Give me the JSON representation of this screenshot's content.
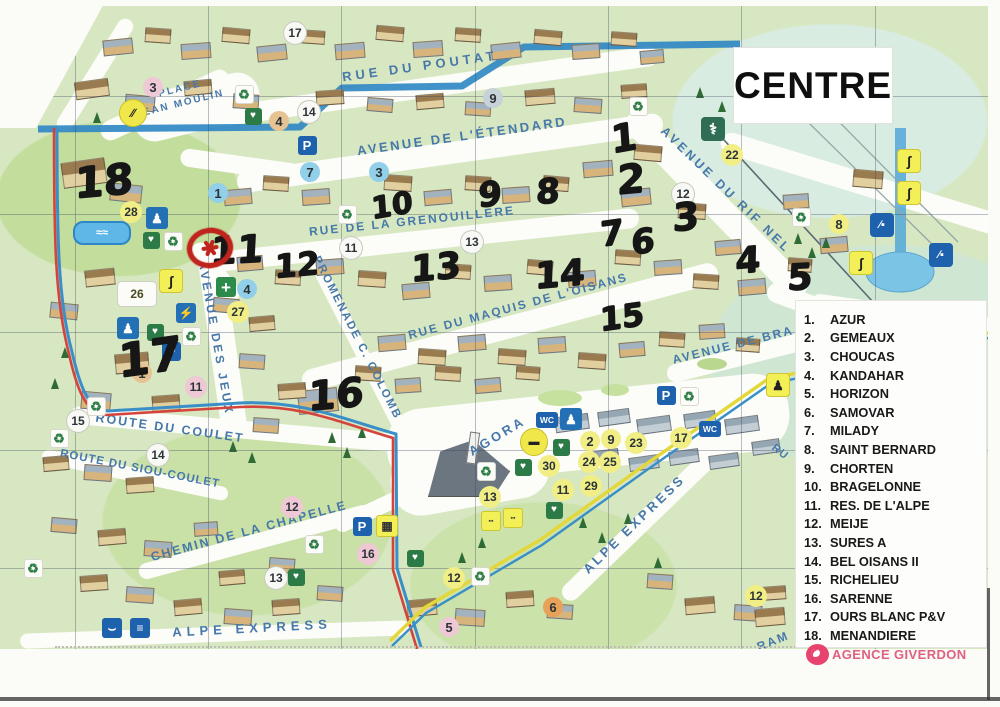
{
  "page": {
    "title": "CENTRE"
  },
  "legend": {
    "items": [
      {
        "num": "1.",
        "name": "AZUR"
      },
      {
        "num": "2.",
        "name": "GEMEAUX"
      },
      {
        "num": "3.",
        "name": "CHOUCAS"
      },
      {
        "num": "4.",
        "name": "KANDAHAR"
      },
      {
        "num": "5.",
        "name": "HORIZON"
      },
      {
        "num": "6.",
        "name": "SAMOVAR"
      },
      {
        "num": "7.",
        "name": "MILADY"
      },
      {
        "num": "8.",
        "name": "SAINT BERNARD"
      },
      {
        "num": "9.",
        "name": "CHORTEN"
      },
      {
        "num": "10.",
        "name": "BRAGELONNE"
      },
      {
        "num": "11.",
        "name": "RES. DE L'ALPE"
      },
      {
        "num": "12.",
        "name": "MEIJE"
      },
      {
        "num": "13.",
        "name": "SURES A"
      },
      {
        "num": "14.",
        "name": "BEL OISANS II"
      },
      {
        "num": "15.",
        "name": "RICHELIEU"
      },
      {
        "num": "16.",
        "name": "SARENNE"
      },
      {
        "num": "17.",
        "name": "OURS BLANC P&V"
      },
      {
        "num": "18.",
        "name": "MENANDIERE"
      }
    ]
  },
  "agency": {
    "name": "AGENCE GIVERDON"
  },
  "map": {
    "street_labels": [
      {
        "text": "ROU.",
        "x": 80,
        "y": 38,
        "rotate": -58,
        "size": 11,
        "spacing": 2
      },
      {
        "text": "RUE DU POUTAT",
        "x": 420,
        "y": 66,
        "rotate": -8,
        "size": 13,
        "spacing": 4
      },
      {
        "text": "PLACE",
        "x": 180,
        "y": 89,
        "rotate": -14,
        "size": 10,
        "spacing": 2
      },
      {
        "text": "JEAN MOULIN",
        "x": 180,
        "y": 104,
        "rotate": -14,
        "size": 10,
        "spacing": 2
      },
      {
        "text": "AVENUE DE L'ÉTENDARD",
        "x": 462,
        "y": 136,
        "rotate": -8,
        "size": 13,
        "spacing": 2.5
      },
      {
        "text": "RUE DE LA GRENOUILLERE",
        "x": 412,
        "y": 221,
        "rotate": -6,
        "size": 12,
        "spacing": 2
      },
      {
        "text": "RUE DU MAQUIS DE L'OISANS",
        "x": 518,
        "y": 306,
        "rotate": -15,
        "size": 12,
        "spacing": 2
      },
      {
        "text": "AVENUE DU RIF NEL",
        "x": 726,
        "y": 190,
        "rotate": 44,
        "size": 12.5,
        "spacing": 3
      },
      {
        "text": "AVENUE DE BRA",
        "x": 733,
        "y": 345,
        "rotate": -14,
        "size": 12,
        "spacing": 2
      },
      {
        "text": "AVENUE DES JEUX",
        "x": 216,
        "y": 338,
        "rotate": 80,
        "size": 12,
        "spacing": 3
      },
      {
        "text": "PROMENADE C. COLOMB",
        "x": 357,
        "y": 338,
        "rotate": 63,
        "size": 11.5,
        "spacing": 2
      },
      {
        "text": "ROUTE DU COULET",
        "x": 170,
        "y": 428,
        "rotate": 8,
        "size": 12.5,
        "spacing": 2
      },
      {
        "text": "ROUTE DU SIOU-COULET",
        "x": 140,
        "y": 469,
        "rotate": 11,
        "size": 11.5,
        "spacing": 1
      },
      {
        "text": "CHEMIN DE LA CHAPELLE",
        "x": 249,
        "y": 531,
        "rotate": -15,
        "size": 12.5,
        "spacing": 2
      },
      {
        "text": "AGORA",
        "x": 497,
        "y": 436,
        "rotate": -31,
        "size": 13,
        "spacing": 3
      },
      {
        "text": "ALPE EXPRESS",
        "x": 252,
        "y": 628,
        "rotate": -3,
        "size": 13,
        "spacing": 5
      },
      {
        "text": "ALPE EXPRESS",
        "x": 634,
        "y": 524,
        "rotate": -44,
        "size": 13,
        "spacing": 3
      },
      {
        "text": "RU",
        "x": 780,
        "y": 452,
        "rotate": 38,
        "size": 11,
        "spacing": 1
      },
      {
        "text": "RAM",
        "x": 773,
        "y": 641,
        "rotate": -22,
        "size": 12,
        "spacing": 2
      }
    ],
    "printed_badges": [
      {
        "num": "17",
        "x": 295,
        "y": 28,
        "style": "white"
      },
      {
        "num": "3",
        "x": 153,
        "y": 82,
        "style": "pink"
      },
      {
        "num": "14",
        "x": 309,
        "y": 107,
        "style": "white"
      },
      {
        "num": "4",
        "x": 279,
        "y": 116,
        "style": "tan"
      },
      {
        "num": "9",
        "x": 493,
        "y": 93,
        "style": "gray"
      },
      {
        "num": "22",
        "x": 732,
        "y": 150,
        "style": "yellow"
      },
      {
        "num": "1",
        "x": 218,
        "y": 188,
        "style": "blue"
      },
      {
        "num": "7",
        "x": 310,
        "y": 167,
        "style": "blue"
      },
      {
        "num": "3",
        "x": 379,
        "y": 167,
        "style": "blue"
      },
      {
        "num": "12",
        "x": 683,
        "y": 189,
        "style": "white"
      },
      {
        "num": "8",
        "x": 839,
        "y": 219,
        "style": "yellow"
      },
      {
        "num": "28",
        "x": 131,
        "y": 207,
        "style": "yellow"
      },
      {
        "num": "11",
        "x": 351,
        "y": 243,
        "style": "white"
      },
      {
        "num": "13",
        "x": 472,
        "y": 237,
        "style": "white"
      },
      {
        "num": "26",
        "x": 137,
        "y": 289,
        "style": "whitebox"
      },
      {
        "num": "4",
        "x": 247,
        "y": 284,
        "style": "blue"
      },
      {
        "num": "27",
        "x": 238,
        "y": 307,
        "style": "yellow"
      },
      {
        "num": "1",
        "x": 142,
        "y": 368,
        "style": "tan"
      },
      {
        "num": "11",
        "x": 196,
        "y": 382,
        "style": "pink"
      },
      {
        "num": "15",
        "x": 78,
        "y": 416,
        "style": "white"
      },
      {
        "num": "14",
        "x": 158,
        "y": 450,
        "style": "white"
      },
      {
        "num": "12",
        "x": 292,
        "y": 502,
        "style": "pink"
      },
      {
        "num": "16",
        "x": 368,
        "y": 549,
        "style": "pink"
      },
      {
        "num": "13",
        "x": 276,
        "y": 573,
        "style": "white"
      },
      {
        "num": "13",
        "x": 490,
        "y": 492,
        "style": "yellow"
      },
      {
        "num": "12",
        "x": 454,
        "y": 573,
        "style": "yellow"
      },
      {
        "num": "5",
        "x": 449,
        "y": 622,
        "style": "pink"
      },
      {
        "num": "6",
        "x": 553,
        "y": 602,
        "style": "orange"
      },
      {
        "num": "12",
        "x": 756,
        "y": 591,
        "style": "yellow"
      },
      {
        "num": "2",
        "x": 590,
        "y": 436,
        "style": "yellow"
      },
      {
        "num": "9",
        "x": 611,
        "y": 434,
        "style": "yellow"
      },
      {
        "num": "23",
        "x": 636,
        "y": 438,
        "style": "yellow"
      },
      {
        "num": "17",
        "x": 681,
        "y": 433,
        "style": "yellow"
      },
      {
        "num": "24",
        "x": 589,
        "y": 457,
        "style": "yellow"
      },
      {
        "num": "25",
        "x": 610,
        "y": 457,
        "style": "yellow"
      },
      {
        "num": "30",
        "x": 549,
        "y": 461,
        "style": "yellow"
      },
      {
        "num": "11",
        "x": 563,
        "y": 485,
        "style": "yellow"
      },
      {
        "num": "29",
        "x": 591,
        "y": 481,
        "style": "yellow"
      }
    ],
    "handwritten_numbers": [
      {
        "num": "18",
        "x": 104,
        "y": 176,
        "size": 42,
        "rotate": -5
      },
      {
        "num": "17",
        "x": 150,
        "y": 352,
        "size": 46,
        "rotate": -8
      },
      {
        "num": "11",
        "x": 237,
        "y": 245,
        "size": 38,
        "rotate": -3
      },
      {
        "num": "12",
        "x": 297,
        "y": 260,
        "size": 32,
        "rotate": -5
      },
      {
        "num": "10",
        "x": 392,
        "y": 201,
        "size": 30,
        "rotate": -10
      },
      {
        "num": "9",
        "x": 490,
        "y": 190,
        "size": 34,
        "rotate": -5
      },
      {
        "num": "8",
        "x": 548,
        "y": 187,
        "size": 34,
        "rotate": -3
      },
      {
        "num": "13",
        "x": 436,
        "y": 263,
        "size": 36,
        "rotate": -5
      },
      {
        "num": "14",
        "x": 560,
        "y": 270,
        "size": 36,
        "rotate": -5
      },
      {
        "num": "15",
        "x": 622,
        "y": 312,
        "size": 32,
        "rotate": -8
      },
      {
        "num": "16",
        "x": 336,
        "y": 390,
        "size": 40,
        "rotate": -5
      },
      {
        "num": "1",
        "x": 624,
        "y": 133,
        "size": 38,
        "rotate": -10
      },
      {
        "num": "2",
        "x": 631,
        "y": 175,
        "size": 40,
        "rotate": -5
      },
      {
        "num": "3",
        "x": 686,
        "y": 212,
        "size": 38,
        "rotate": -5
      },
      {
        "num": "7",
        "x": 612,
        "y": 229,
        "size": 34,
        "rotate": -8
      },
      {
        "num": "6",
        "x": 643,
        "y": 237,
        "size": 34,
        "rotate": -5
      },
      {
        "num": "4",
        "x": 748,
        "y": 256,
        "size": 36,
        "rotate": -5
      },
      {
        "num": "5",
        "x": 800,
        "y": 273,
        "size": 36,
        "rotate": -3
      }
    ],
    "icons": [
      {
        "name": "recycle-icon",
        "x": 35,
        "y": 74
      },
      {
        "name": "recycle-icon",
        "x": 243,
        "y": 88
      },
      {
        "name": "recycle-icon",
        "x": 637,
        "y": 100
      },
      {
        "name": "recycle-icon",
        "x": 346,
        "y": 208
      },
      {
        "name": "recycle-icon",
        "x": 800,
        "y": 211
      },
      {
        "name": "recycle-icon",
        "x": 172,
        "y": 235
      },
      {
        "name": "recycle-icon",
        "x": 190,
        "y": 330
      },
      {
        "name": "recycle-icon",
        "x": 688,
        "y": 390
      },
      {
        "name": "recycle-icon",
        "x": 95,
        "y": 400
      },
      {
        "name": "recycle-icon",
        "x": 58,
        "y": 432
      },
      {
        "name": "recycle-icon",
        "x": 485,
        "y": 465
      },
      {
        "name": "recycle-icon",
        "x": 313,
        "y": 538
      },
      {
        "name": "recycle-icon",
        "x": 479,
        "y": 570
      },
      {
        "name": "recycle-icon",
        "x": 32,
        "y": 562
      },
      {
        "name": "parking-icon",
        "x": 307,
        "y": 140
      },
      {
        "name": "parking-icon",
        "x": 171,
        "y": 346
      },
      {
        "name": "parking-icon",
        "x": 666,
        "y": 390
      },
      {
        "name": "parking-icon",
        "x": 362,
        "y": 521
      },
      {
        "name": "wc-icon",
        "x": 547,
        "y": 415
      },
      {
        "name": "wc-icon",
        "x": 710,
        "y": 424
      },
      {
        "name": "doctor-icon",
        "x": 713,
        "y": 124
      },
      {
        "name": "baby-change-icon",
        "x": 157,
        "y": 213
      },
      {
        "name": "baby-change-icon",
        "x": 128,
        "y": 323
      },
      {
        "name": "picnic-icon",
        "x": 571,
        "y": 414
      },
      {
        "name": "first-aid-icon",
        "x": 253,
        "y": 111
      },
      {
        "name": "first-aid-icon",
        "x": 151,
        "y": 235
      },
      {
        "name": "first-aid-icon",
        "x": 155,
        "y": 327
      },
      {
        "name": "first-aid-icon",
        "x": 561,
        "y": 442
      },
      {
        "name": "first-aid-icon",
        "x": 523,
        "y": 462
      },
      {
        "name": "first-aid-icon",
        "x": 554,
        "y": 505
      },
      {
        "name": "first-aid-icon",
        "x": 415,
        "y": 553
      },
      {
        "name": "first-aid-icon",
        "x": 296,
        "y": 572
      },
      {
        "name": "pharmacy-icon",
        "x": 226,
        "y": 282
      },
      {
        "name": "ev-plug-icon",
        "x": 186,
        "y": 308
      },
      {
        "name": "ski-school-icon",
        "x": 132,
        "y": 107
      },
      {
        "name": "gondola-icon",
        "x": 533,
        "y": 436
      },
      {
        "name": "chairlift-icon",
        "x": 882,
        "y": 220
      },
      {
        "name": "chairlift-icon",
        "x": 941,
        "y": 250
      },
      {
        "name": "sled-icon",
        "x": 112,
        "y": 623
      },
      {
        "name": "ski-lift-icon",
        "x": 140,
        "y": 623
      },
      {
        "name": "sport-icon",
        "x": 908,
        "y": 155
      },
      {
        "name": "sport-icon",
        "x": 908,
        "y": 187
      },
      {
        "name": "sport-icon",
        "x": 860,
        "y": 257
      },
      {
        "name": "soccer-icon",
        "x": 777,
        "y": 379
      },
      {
        "name": "sport-icon",
        "x": 170,
        "y": 275
      },
      {
        "name": "shop-icon",
        "x": 490,
        "y": 515
      },
      {
        "name": "shop-icon",
        "x": 512,
        "y": 512
      },
      {
        "name": "basket-icon",
        "x": 386,
        "y": 520
      },
      {
        "name": "pool-icon",
        "x": 100,
        "y": 226
      }
    ],
    "marker": {
      "name": "red-circle-marker",
      "x": 210,
      "y": 243
    }
  },
  "colors": {
    "street_text": "#4678aa",
    "handwriting": "#161616",
    "marker_red": "#c0251d",
    "agency_pink": "#e45a7d",
    "water_blue": "#2e86c4",
    "route_red": "#d5443c",
    "route_yellow": "#e3d73a",
    "badge_yellow": "#f1ee86",
    "badge_blue": "#92cfe9"
  }
}
